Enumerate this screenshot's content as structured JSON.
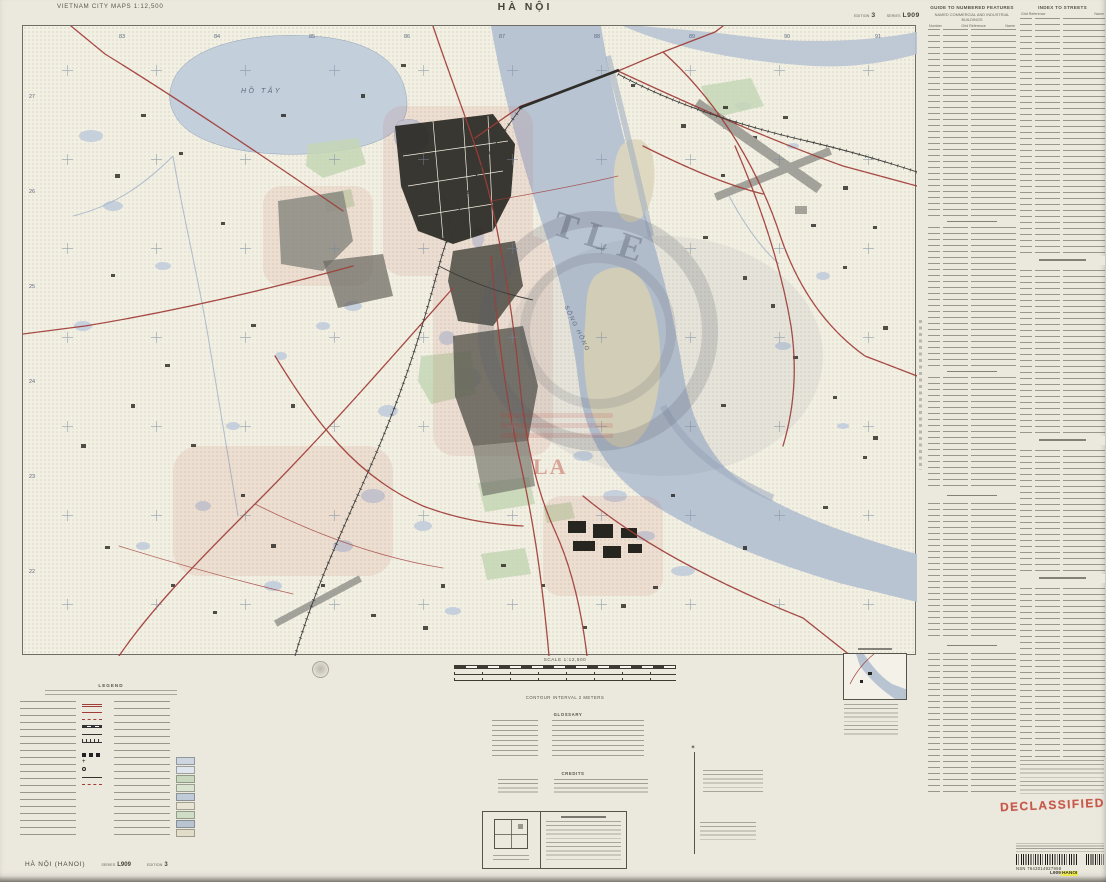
{
  "document": {
    "series_title": "VIETNAM CITY MAPS 1:12,500",
    "sheet_title": "HÀ NỘI",
    "edition_label": "EDITION",
    "edition_value": "3",
    "series_label": "SERIES",
    "series_value": "L909",
    "footer_sheet_name": "HÀ NỘI (HANOI)",
    "declassified_stamp": "DECLASSIFIED",
    "nsn_text": "NSN 7643014927958",
    "stock_number_prefix": "L909",
    "stock_number_highlighted": "HANOI"
  },
  "index_numbered_features": {
    "title": "GUIDE TO NUMBERED FEATURES",
    "subtitle": "NAMED COMMERCIAL AND INDUSTRIAL BUILDINGS",
    "columns": [
      "Number",
      "Grid Reference",
      "Name"
    ]
  },
  "index_streets": {
    "title": "INDEX TO STREETS",
    "columns": [
      "Grid Reference",
      "Name"
    ]
  },
  "map": {
    "labels": {
      "west_lake": "HỒ TÂY",
      "river": "SÔNG HỒNG"
    },
    "ghost_stamp_letters": "TLE",
    "red_stamp_letters": "LA",
    "grid_top": [
      "83",
      "84",
      "85",
      "86",
      "87",
      "88",
      "89",
      "90",
      "91"
    ],
    "grid_left": [
      "27",
      "26",
      "25",
      "24",
      "23",
      "22"
    ]
  },
  "marginalia": {
    "legend_title": "LEGEND",
    "scale_text": "SCALE 1:12,500",
    "contour_text": "CONTOUR INTERVAL 2 METERS",
    "glossary_title": "GLOSSARY",
    "credits_title": "CREDITS"
  },
  "colors": {
    "paper": "#ebe8de",
    "map_bg": "#f2efe3",
    "water": "#b9c4d3",
    "water_light": "#c4cfdc",
    "sandbar": "#ddd6bd",
    "urban_dark": "#26251f",
    "urban_gray": "#8b8b83",
    "park_green": "#c6d7b6",
    "road_red": "#a03d38",
    "rail_black": "#3a3a36",
    "grid_blue": "#76889e",
    "runway_gray": "#a2a29b",
    "stamp_red": "#c03a2b",
    "highlight_yellow": "#ece94f",
    "ghost_gray": "#596070"
  }
}
